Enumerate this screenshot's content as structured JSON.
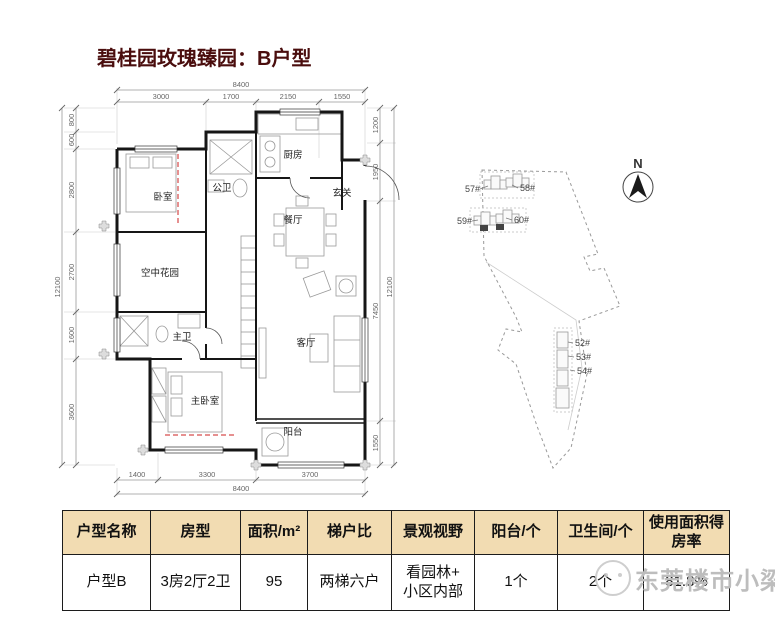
{
  "title": "碧桂园玫瑰臻园：B户型",
  "floor_plan": {
    "rooms": {
      "bedroom": "卧室",
      "public_bath": "公卫",
      "kitchen": "厨房",
      "entry": "玄关",
      "dining": "餐厅",
      "sky_garden": "空中花园",
      "master_bath": "主卫",
      "master_bedroom": "主卧室",
      "living": "客厅",
      "balcony": "阳台"
    },
    "dims": {
      "top_total": "8400",
      "top": [
        "3000",
        "1700",
        "2150",
        "1550"
      ],
      "bottom": [
        "1400",
        "3300",
        "3700"
      ],
      "bottom_total": "8400",
      "left": [
        "800",
        "600",
        "2800",
        "2700",
        "1600",
        "3600"
      ],
      "left_total": "12100",
      "right": [
        "1200",
        "1950",
        "7450",
        "1550"
      ],
      "right_total": "12100"
    }
  },
  "site_plan": {
    "north": "N",
    "buildings": [
      "57#",
      "58#",
      "59#",
      "60#",
      "52#",
      "53#",
      "54#"
    ]
  },
  "table": {
    "headers": [
      "户型名称",
      "房型",
      "面积/m²",
      "梯户比",
      "景观视野",
      "阳台/个",
      "卫生间/个",
      "使用面积得房率"
    ],
    "row": [
      "户型B",
      "3房2厅2卫",
      "95",
      "两梯六户",
      "看园林+\n小区内部",
      "1个",
      "2个",
      "81.8%"
    ]
  },
  "watermark": {
    "text": "东莞楼市小梁"
  },
  "colors": {
    "header_bg": "#f2dcb2",
    "title_color": "#4a0d0d",
    "watermark_color": "#bdbdbd",
    "red_dash": "#cc2222"
  }
}
